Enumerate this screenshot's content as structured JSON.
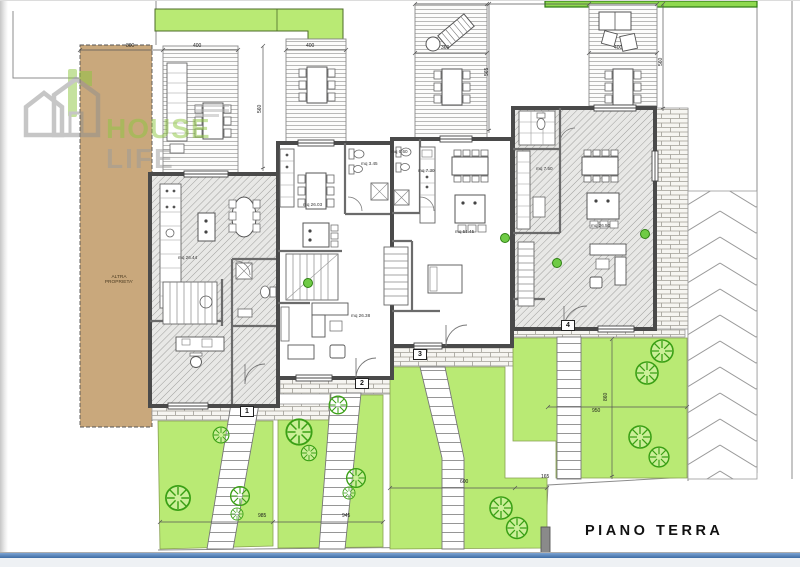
{
  "plan": {
    "title": "PIANO TERRA"
  },
  "watermark": {
    "word1": "HOUSE",
    "word2": "LIFE"
  },
  "neighbor": {
    "line1": "ALTRA",
    "line2": "PROPRIETA'"
  },
  "badges": [
    {
      "n": "1"
    },
    {
      "n": "2"
    },
    {
      "n": "3"
    },
    {
      "n": "4"
    }
  ],
  "rooms": [
    {
      "t": "mq 26.44"
    },
    {
      "t": "mq 26.03"
    },
    {
      "t": "mq 3.45"
    },
    {
      "t": "mq 26.38"
    },
    {
      "t": "mq 6.60"
    },
    {
      "t": "mq 7.30"
    },
    {
      "t": "mq 51.45"
    },
    {
      "t": "mq 7.50"
    },
    {
      "t": "mq 26.50"
    }
  ],
  "dims": [
    {
      "t": "800"
    },
    {
      "t": "400"
    },
    {
      "t": "400"
    },
    {
      "t": "360"
    },
    {
      "t": "400"
    },
    {
      "t": "560"
    },
    {
      "t": "565"
    },
    {
      "t": "560"
    },
    {
      "t": "985"
    },
    {
      "t": "945"
    },
    {
      "t": "600"
    },
    {
      "t": "165"
    },
    {
      "t": "950"
    },
    {
      "t": "860"
    }
  ],
  "colors": {
    "garden_green": "#b9ea74",
    "top_strip_green": "#8fd94f",
    "neighbor_brown": "#c9a87c",
    "wall_gray": "#4a4a4a",
    "logo_green": "#8dc63f",
    "footer_blue": "#4a7cb5",
    "tree_green": "#3aa015"
  }
}
